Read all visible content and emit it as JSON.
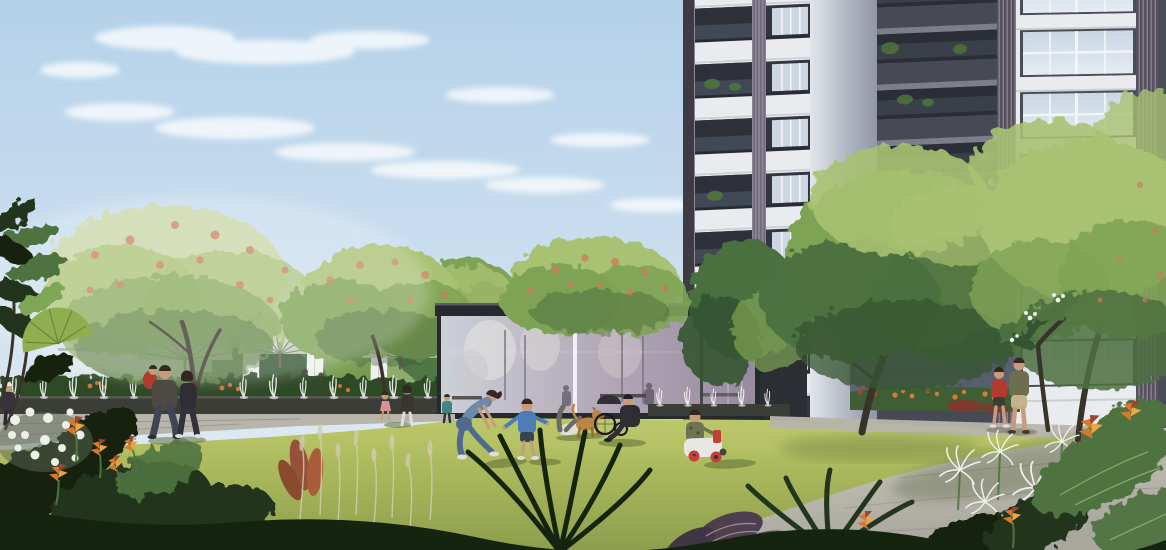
{
  "meta": {
    "description": "Architectural rendering of a residential park courtyard: sunlit lawn with families, a tropical fountain plaza with pergola and fan palms, a glass pavilion, and a tall grey apartment tower behind trees under a blue sky with wispy clouds."
  },
  "colors": {
    "sky-top": "#b4d1e9",
    "sky-mid": "#c9ddee",
    "sky-low": "#dfeaf2",
    "cloud": "#f7fafc",
    "glow": "#ffffff",
    "bldg-white": "#e9ebee",
    "bldg-white-shade": "#c9cdd4",
    "bldg-edge": "#3f3b45",
    "soffit": "#23262e",
    "void-dark": "#2e313a",
    "railing": "#566171",
    "pilaster": "#8d8595",
    "pilaster-line": "#675f70",
    "corner-light": "#e3e6eb",
    "corner-mid": "#b9bfca",
    "corner-dark": "#8f96a6",
    "slab-light": "#7a7f8a",
    "darksec": "#474a55",
    "darksec-void": "#2b2e36",
    "louver": "#57515e",
    "louver-line": "#8f8798",
    "win-frame": "#4a4d56",
    "win-glass-1": "#ccd7e2",
    "win-glass-2": "#e4ebf2",
    "mullion": "#f2f4f6",
    "pav-frame": "#26292e",
    "pav-back": "#2b2e33",
    "pav-glass-1": "#ccd1d8",
    "pav-glass-2": "#b3a9b8",
    "pav-glass-3": "#97899f",
    "pav-light": "#5a5f66",
    "tree-pale": "#c9d6a4",
    "tree-light": "#a9c172",
    "tree-mid": "#7fa355",
    "tree-dark": "#4c7040",
    "tree-deep": "#345430",
    "blossom": "#cd7a5c",
    "blossom-soft": "#e09a78",
    "trunk": "#6b5d4c",
    "trunk-dark": "#3a332b",
    "palm-fan": "#c6cdbf",
    "fan-line": "#5d6d52",
    "pergola-beam": "#ded9cf",
    "pergola-shade": "#8a8077",
    "curtain": "#eef0ec",
    "curtain-shade": "#c2c3bb",
    "hedge": "#2e4a28",
    "pool": "#3a3e36",
    "pool-edge": "#565b50",
    "jet": "#f2f5f0",
    "lawn-1": "#bcc86a",
    "lawn-2": "#a3b258",
    "lawn-3": "#8d9d4c",
    "lawn-shadow": "#5f7038",
    "path-1": "#b7b4ab",
    "path-2": "#cfccc3",
    "path-3": "#a9a69d",
    "path-joint": "#8f8c84",
    "path-dark": "#6f6d66",
    "plant-dark": "#22361d",
    "plant-deep": "#15240f",
    "leaf-mid": "#4f7340",
    "leaf-light": "#7fa557",
    "leaf-vein": "#a3c27a",
    "heliconia-1": "#d8792f",
    "heliconia-2": "#eda543",
    "foliage-red": "#96513a",
    "grass-plume": "#d3cbae",
    "lily": "#edf0e8",
    "flower-orange": "#d97a3a",
    "flower-red": "#9c4632",
    "red-leaf": "#7e3b2e",
    "skin": "#c79b7c",
    "hair": "#33281f",
    "denim-1": "#6d88a8",
    "denim-2": "#50698f",
    "jacket-blue": "#4e7cb4",
    "white-cloth": "#dfdfda",
    "dark-cloth": "#2e2e34",
    "gray-jacket": "#4d4a46",
    "jeans": "#3f4552",
    "olive-shirt": "#6e6e4e",
    "khaki": "#c3b28a",
    "red-shirt": "#b23a2e",
    "teal": "#3f8585",
    "pink": "#d8919c",
    "camo": "#6d7251",
    "camo-dark": "#4a5038",
    "toy-white": "#e9e7e3",
    "toy-red": "#c24038",
    "dog-1": "#bb8544",
    "dog-2": "#9a6a30",
    "shadow-green": "#55662f",
    "shadow-warm": "#6b6a55"
  },
  "scene": {
    "setting": "residential park courtyard with lawn, fountain plaza, pergola, glass pavilion and high-rise apartment tower",
    "sky": {
      "cloud_count": 12
    },
    "building": {
      "left_tower_floors_visible": 8,
      "right_facade_floors_visible": 7,
      "balcony_planters": true
    },
    "pavilion": {
      "glass_panels": 4,
      "occupants_visible": 2,
      "benches_visible": 3
    },
    "fountain": {
      "jets_left": 13,
      "jets_right": 5
    },
    "pergola": {
      "curtains": 3,
      "fan_palms": 4
    },
    "people": [
      {
        "name": "man-carrying-child",
        "detail": "dark jacket, carrying toddler in red"
      },
      {
        "name": "woman-walking",
        "detail": "dark outfit, walking beside man"
      },
      {
        "name": "mother-with-child-pink",
        "detail": "small child in pink dress"
      },
      {
        "name": "woman-playing",
        "detail": "denim outfit, bending toward toddler"
      },
      {
        "name": "toddler-blue",
        "detail": "blue jacket, arms out"
      },
      {
        "name": "person-lying",
        "detail": "white t-shirt, lying on lawn with leg raised"
      },
      {
        "name": "golden-dog",
        "detail": "standing on lawn"
      },
      {
        "name": "man-with-stroller",
        "detail": "seated, dark clothes, black stroller wheel"
      },
      {
        "name": "child-on-ride-on-toy",
        "detail": "camouflage outfit, white and red toy car"
      },
      {
        "name": "father-and-son",
        "detail": "walking away on path, olive shirt and red shirt"
      },
      {
        "name": "child-teal",
        "detail": "tiny figure at left lawn edge"
      },
      {
        "name": "figure-white-cap",
        "detail": "tiny figure at far left edge"
      }
    ],
    "furniture": {
      "white_garden_chair": 1
    }
  }
}
